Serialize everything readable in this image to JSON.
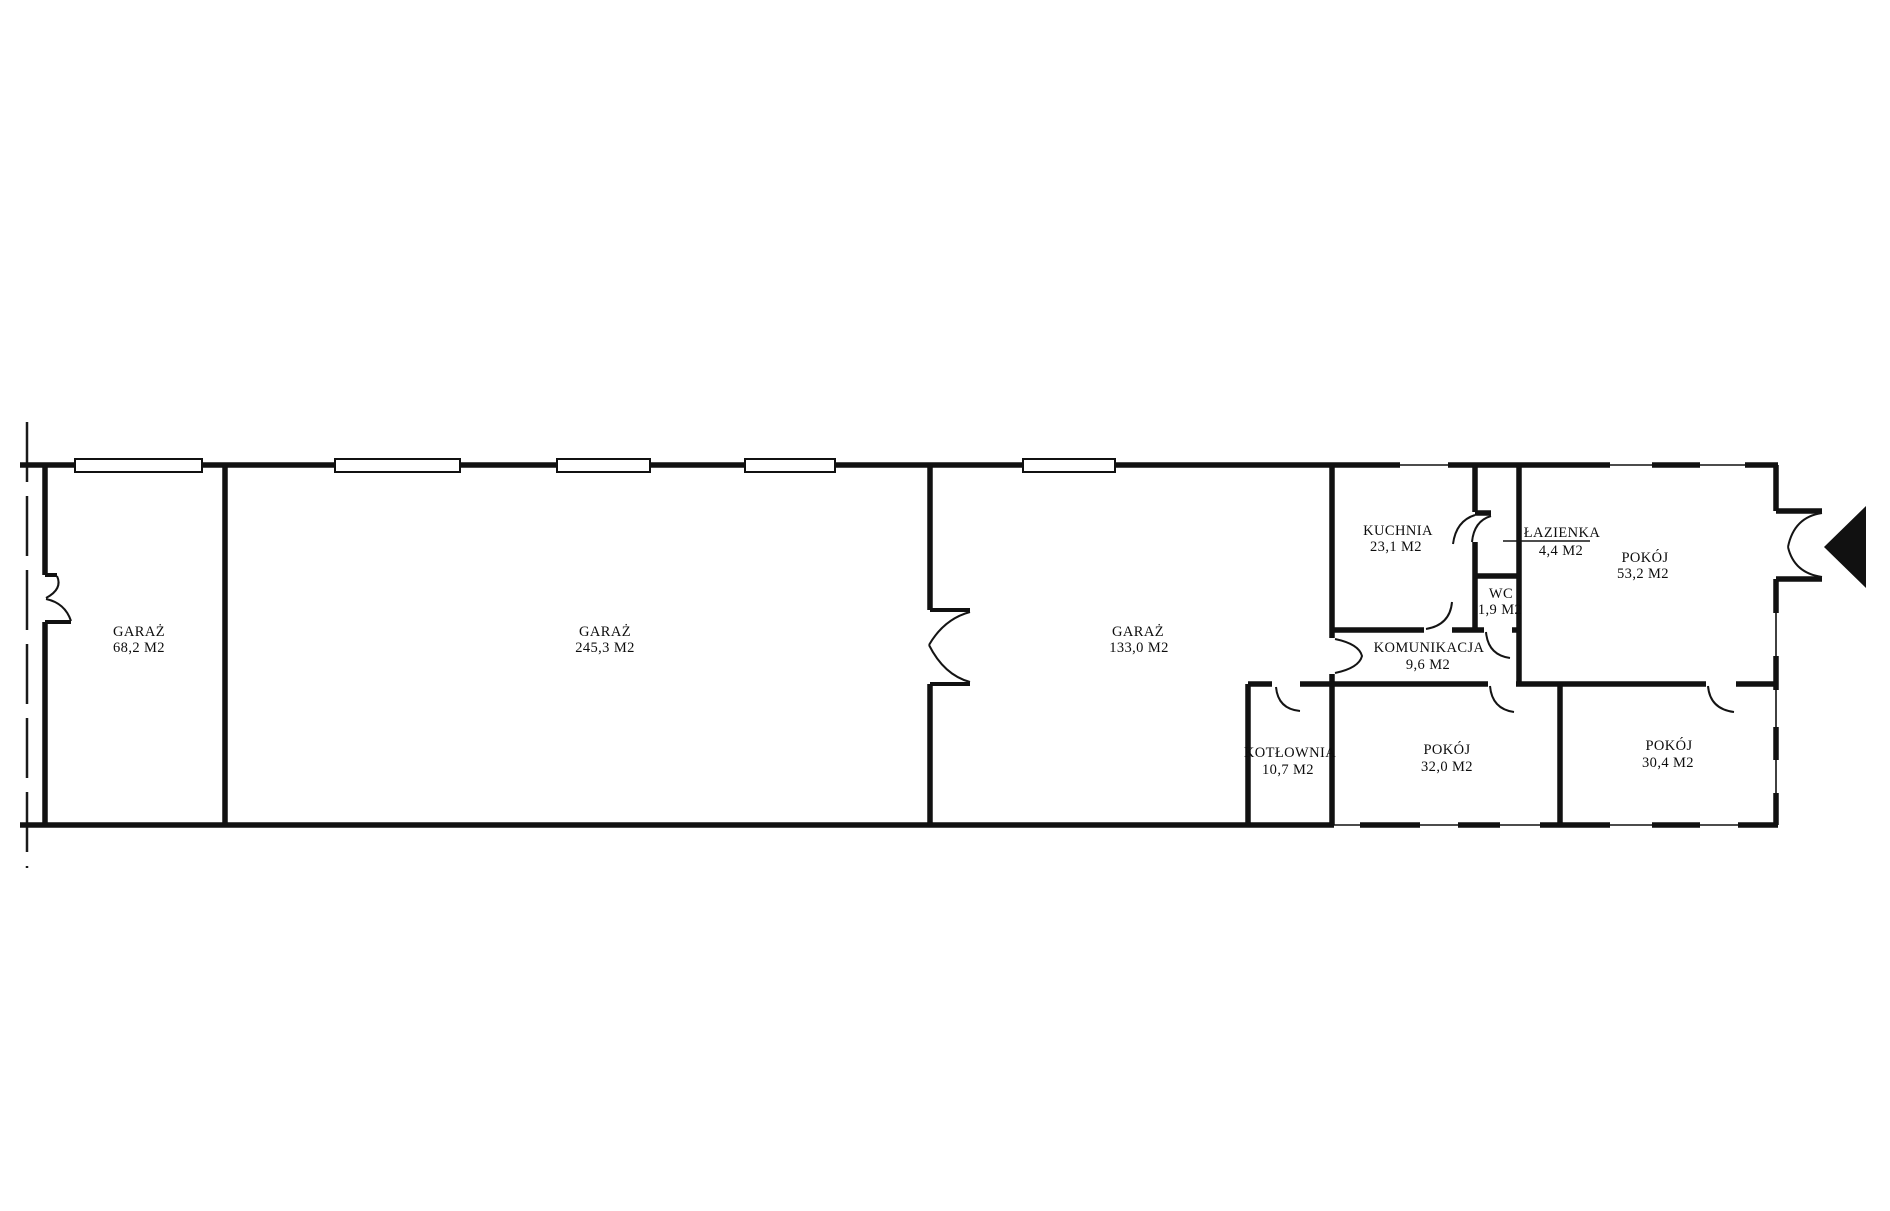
{
  "plan": {
    "type": "architectural-floor-plan",
    "rooms": [
      {
        "name": "GARAŻ",
        "area": "68,2 M2"
      },
      {
        "name": "GARAŻ",
        "area": "245,3 M2"
      },
      {
        "name": "GARAŻ",
        "area": "133,0 M2"
      },
      {
        "name": "KUCHNIA",
        "area": "23,1 M2"
      },
      {
        "name": "ŁAZIENKA",
        "area": "4,4 M2"
      },
      {
        "name": "WC",
        "area": "1,9 M2"
      },
      {
        "name": "POKÓJ",
        "area": "53,2 M2"
      },
      {
        "name": "KOMUNIKACJA",
        "area": "9,6 M2"
      },
      {
        "name": "KOTŁOWNIA",
        "area": "10,7 M2"
      },
      {
        "name": "POKÓJ",
        "area": "32,0 M2"
      },
      {
        "name": "POKÓJ",
        "area": "30,4 M2"
      }
    ],
    "colors": {
      "wall": "#111111",
      "background": "#ffffff",
      "entrance_marker": "#111111"
    }
  }
}
